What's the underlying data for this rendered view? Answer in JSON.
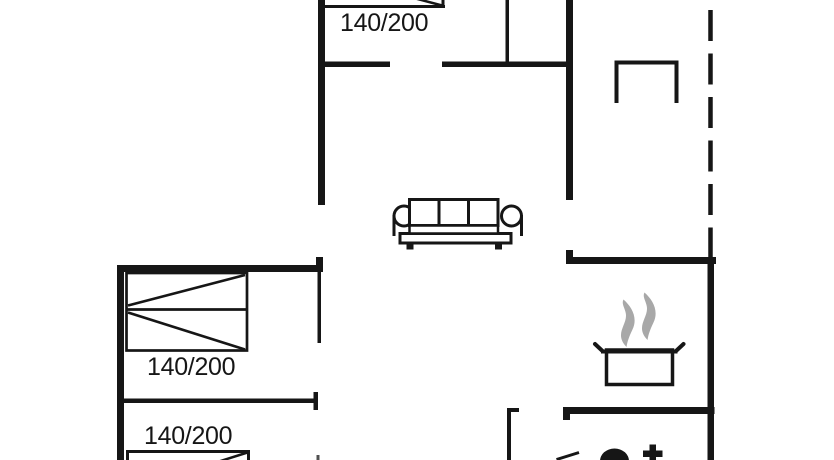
{
  "colors": {
    "line": "#161616",
    "steam": "#a8a8a8",
    "background": "#ffffff"
  },
  "labels": {
    "bed_top": "140/200",
    "bed_middle": "140/200",
    "bed_bottom": "140/200"
  },
  "icons": [
    "bed-icon",
    "sofa-icon",
    "dining-table-icon",
    "cooking-pot-icon",
    "steam-icon",
    "toilet-icon",
    "faucet-cross-icon"
  ]
}
